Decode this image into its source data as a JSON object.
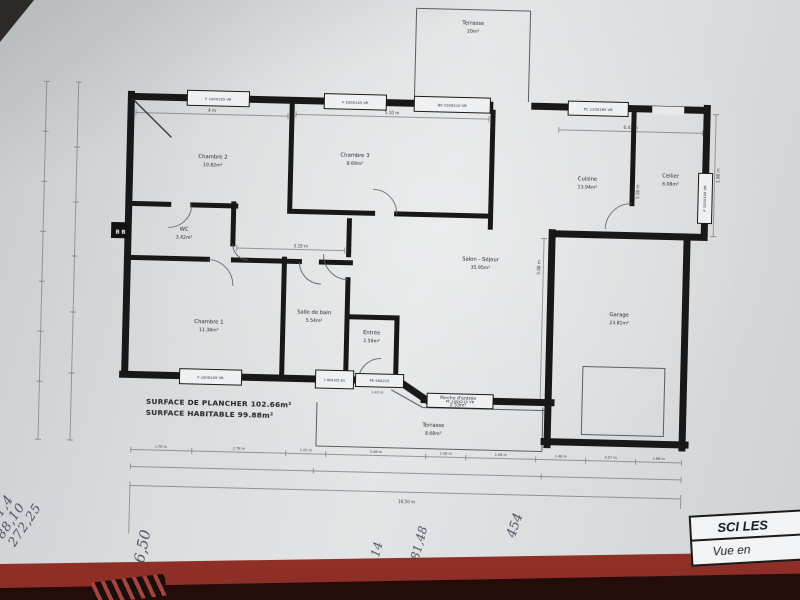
{
  "plan": {
    "door_marker": "B B",
    "rooms": {
      "chambre2": {
        "name": "Chambre 2",
        "area": "10.82m²"
      },
      "chambre3": {
        "name": "Chambre 3",
        "area": "8.69m²"
      },
      "cuisine": {
        "name": "Cuisine",
        "area": "13.94m²"
      },
      "cellier": {
        "name": "Cellier",
        "area": "6.08m²"
      },
      "salon": {
        "name": "Salon - Séjour",
        "area": "35.95m²"
      },
      "wc": {
        "name": "WC",
        "area": "3.42m²"
      },
      "chambre1": {
        "name": "Chambre 1",
        "area": "11.38m²"
      },
      "sdb": {
        "name": "Salle de bain",
        "area": "5.54m²"
      },
      "entree": {
        "name": "Entrée",
        "area": "2.59m²"
      },
      "garage": {
        "name": "Garage",
        "area": "23.81m²"
      },
      "porche": {
        "name": "Porche d'entrée",
        "area": "2.53m²"
      },
      "terrasse_haut": {
        "name": "Terrasse",
        "area": "20m²"
      },
      "terrasse_bas": {
        "name": "Terrasse",
        "area": "8.68m²"
      }
    },
    "openings": {
      "top1": "F 100X105 VR",
      "top2": "F 100X105 VR",
      "top3": "BV 220X210 VR",
      "top4": "PC 120X165 VR",
      "right1": "F 100X105 VR",
      "bottom1": "F 100X105 VR",
      "bath": "F 60X105 SG",
      "entry_door": "PE 90X215",
      "porch_door": "PF 100X215 VR"
    },
    "dimensions": {
      "top1": "4 m",
      "top2": "5.10 m",
      "top3": "6.47 m",
      "right1": "1.98 m",
      "right2": "5.58 m",
      "right3": "5.08 m",
      "interior1": "3.19 m",
      "interior2": "1.43 m",
      "bottom": [
        "1.78 m",
        "2.78 m",
        "1.20 m",
        "3.08 m",
        "1.08 m",
        "1.98 m",
        "1.48 m",
        "4.57 m",
        "1.68 m"
      ],
      "total": "16.50 m"
    },
    "summary": {
      "plancher": "SURFACE DE PLANCHER 102.66m²",
      "habitable": "SURFACE HABITABLE 99.88m²"
    }
  },
  "title_block": {
    "line1": "SCI LES",
    "line2": "Vue en"
  },
  "handwriting": {
    "margin": [
      "= √",
      "371,4",
      "88,10",
      "272,25"
    ],
    "note1": "16,50",
    "note2": "3,14",
    "note3": "81,48",
    "note4": "454"
  },
  "colors": {
    "paper": "#dadcde",
    "wall": "#181818",
    "table_red": "#a8423a",
    "table_dark": "#3a1510",
    "ink": "#3c4256"
  }
}
